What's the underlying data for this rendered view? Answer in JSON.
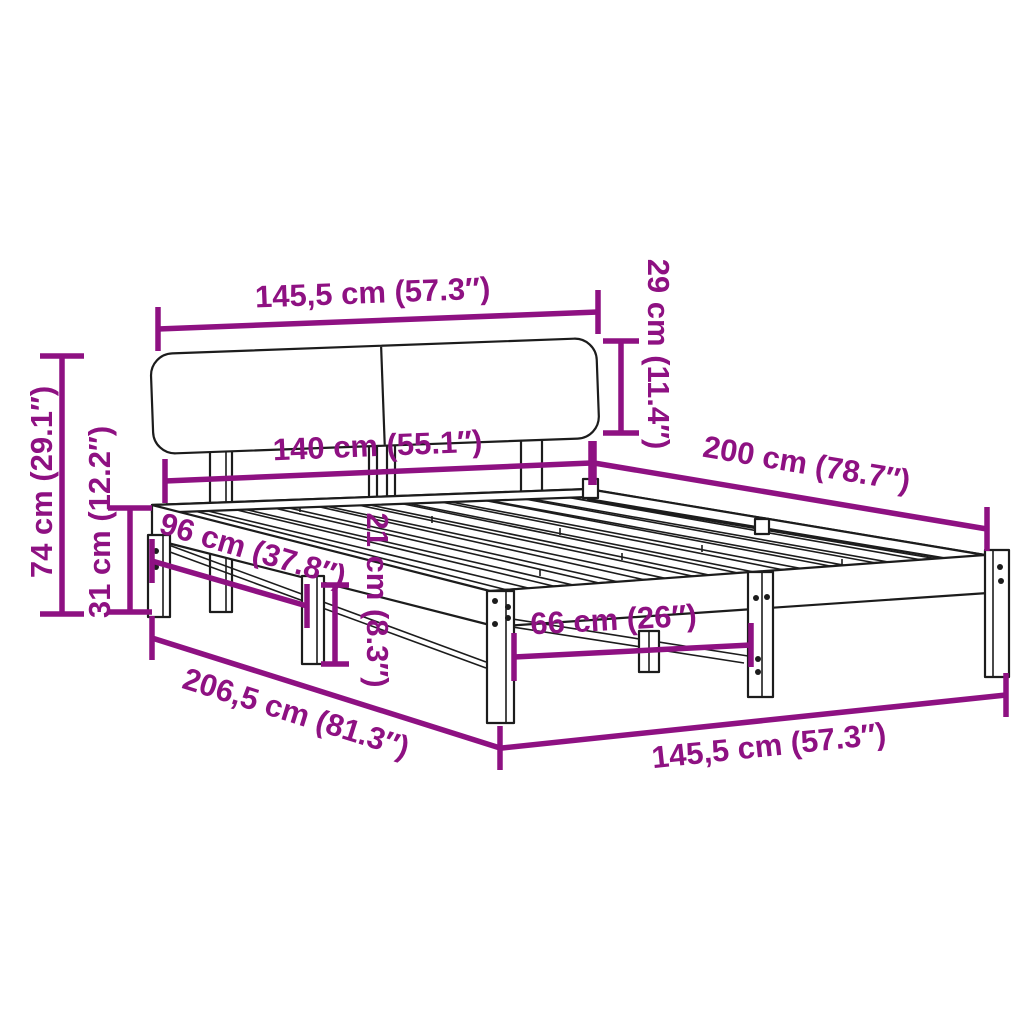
{
  "diagram": {
    "subject": "bed-frame-with-headboard-dimension-diagram",
    "colors": {
      "dimension_accent": "#8e1182",
      "line_art": "#1c1c1c",
      "background": "#ffffff"
    },
    "dimensions": {
      "headboard_width": "145,5 cm (57.3″)",
      "headboard_height": "29 cm (11.4″)",
      "total_height": "74 cm (29.1″)",
      "platform_height": "31 cm (12.2″)",
      "mattress_width": "140 cm (55.1″)",
      "mattress_length": "200 cm (78.7″)",
      "side_leg_spacing": "96 cm (37.8″)",
      "underbed_clearance": "21 cm (8.3″)",
      "front_leg_spacing": "66 cm (26″)",
      "total_length": "206,5 cm (81.3″)",
      "frame_width": "145,5 cm (57.3″)"
    }
  }
}
